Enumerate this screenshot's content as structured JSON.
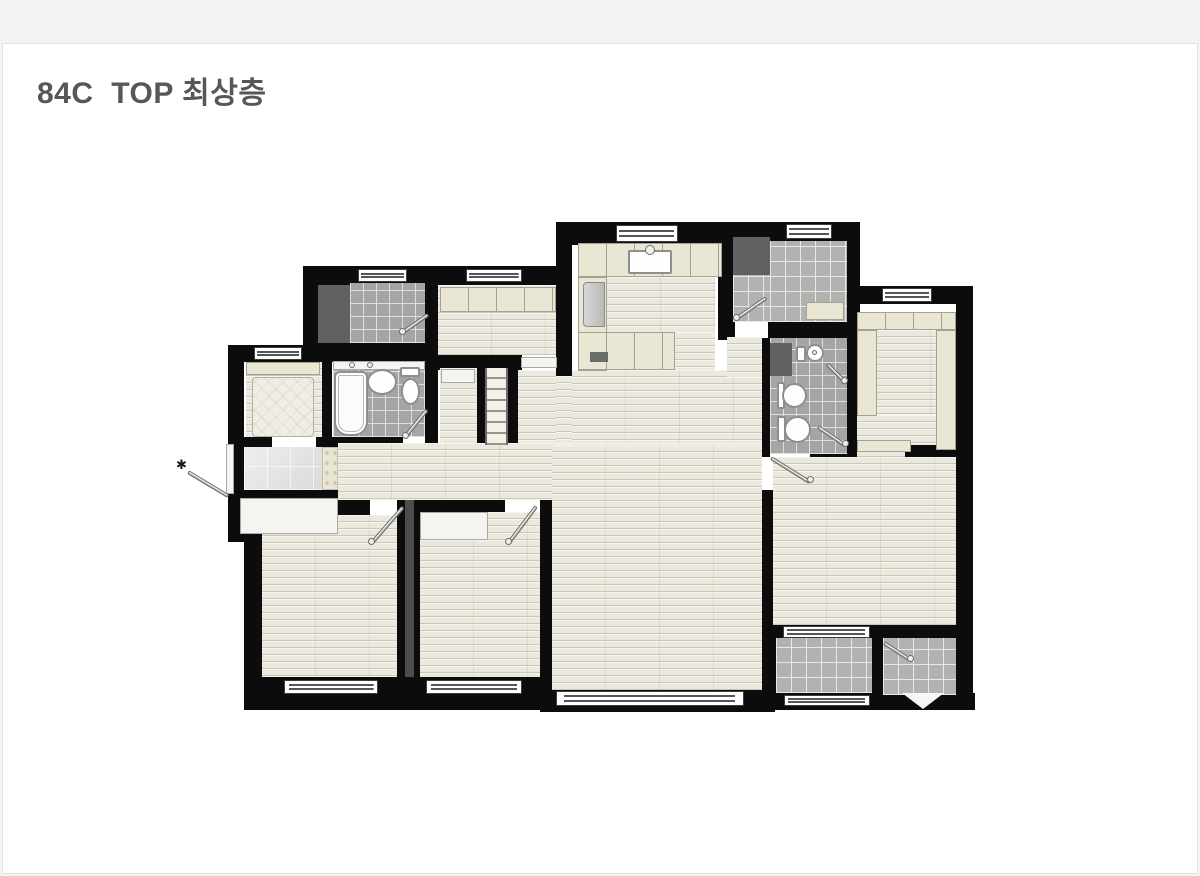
{
  "header": {
    "title": "84C  TOP 최상층"
  },
  "colors": {
    "page_background": "#f3f3f1",
    "card_background": "#ffffff",
    "title_text": "#56575b",
    "wall": "#0c0c0c",
    "wood_floor": "#ebe8dd",
    "bath_tile": "#a5a5a3",
    "balcony_tile": "#b2b2b0",
    "cabinet_beige": "#e9e6d4",
    "dark_unit": "#616161"
  },
  "plan": {
    "elements": [
      {
        "n": "wall-kitchen-top",
        "t": "wall",
        "x": 556,
        "y": 222,
        "w": 177,
        "h": 23
      },
      {
        "n": "wall-kitchen-left",
        "t": "wall",
        "x": 556,
        "y": 245,
        "w": 16,
        "h": 131
      },
      {
        "n": "wall-kitchen-right",
        "t": "wall",
        "x": 718,
        "y": 245,
        "w": 15,
        "h": 95
      },
      {
        "n": "wall-laundry-top",
        "t": "wall",
        "x": 727,
        "y": 222,
        "w": 133,
        "h": 20
      },
      {
        "n": "wall-laundry-right",
        "t": "wall",
        "x": 847,
        "y": 222,
        "w": 13,
        "h": 110
      },
      {
        "n": "wall-utility-top",
        "t": "wall",
        "x": 303,
        "y": 266,
        "w": 142,
        "h": 19
      },
      {
        "n": "wall-utility-left",
        "t": "wall",
        "x": 303,
        "y": 285,
        "w": 15,
        "h": 80
      },
      {
        "n": "wall-pantry-top",
        "t": "wall",
        "x": 445,
        "y": 266,
        "w": 127,
        "h": 19
      },
      {
        "n": "wall-study-top",
        "t": "wall",
        "x": 228,
        "y": 345,
        "w": 102,
        "h": 17
      },
      {
        "n": "wall-left-upper",
        "t": "wall",
        "x": 228,
        "y": 362,
        "w": 16,
        "h": 136
      },
      {
        "n": "wall-utility-bottom",
        "t": "wall",
        "x": 303,
        "y": 343,
        "w": 142,
        "h": 19
      },
      {
        "n": "wall-pantry-left",
        "t": "wall",
        "x": 425,
        "y": 283,
        "w": 13,
        "h": 162
      },
      {
        "n": "wall-pantry-bottom",
        "t": "wall",
        "x": 438,
        "y": 355,
        "w": 84,
        "h": 15
      },
      {
        "n": "wall-stair-rail-left",
        "t": "wall",
        "x": 475,
        "y": 368,
        "w": 10,
        "h": 77
      },
      {
        "n": "wall-stair-rail-right",
        "t": "wall",
        "x": 508,
        "y": 368,
        "w": 10,
        "h": 77
      },
      {
        "n": "wall-bath1-bottom",
        "t": "wall",
        "x": 330,
        "y": 437,
        "w": 73,
        "h": 13
      },
      {
        "n": "wall-study-bottom-left",
        "t": "wall",
        "x": 228,
        "y": 437,
        "w": 44,
        "h": 13
      },
      {
        "n": "wall-study-bottom-right",
        "t": "wall",
        "x": 316,
        "y": 437,
        "w": 16,
        "h": 13
      },
      {
        "n": "wall-porch-block",
        "t": "wall",
        "x": 228,
        "y": 490,
        "w": 124,
        "h": 52
      },
      {
        "n": "wall-bedroom1-top",
        "t": "wall",
        "x": 244,
        "y": 500,
        "w": 126,
        "h": 15
      },
      {
        "n": "wall-left-lower",
        "t": "wall",
        "x": 244,
        "y": 515,
        "w": 18,
        "h": 185
      },
      {
        "n": "wall-bedroom1-bottom",
        "t": "wall",
        "x": 244,
        "y": 677,
        "w": 166,
        "h": 33
      },
      {
        "n": "wall-bedroom-divider",
        "t": "wall",
        "x": 397,
        "y": 500,
        "w": 23,
        "h": 190
      },
      {
        "n": "wall-bedroom2-bottom",
        "t": "wall",
        "x": 410,
        "y": 677,
        "w": 142,
        "h": 33
      },
      {
        "n": "wall-bedroom2-top",
        "t": "wall",
        "x": 413,
        "y": 500,
        "w": 92,
        "h": 14
      },
      {
        "n": "wall-bedroom2-living",
        "t": "wall",
        "x": 540,
        "y": 495,
        "w": 12,
        "h": 215
      },
      {
        "n": "wall-living-bottom",
        "t": "wall",
        "x": 540,
        "y": 690,
        "w": 235,
        "h": 22
      },
      {
        "n": "wall-living-master",
        "t": "wall",
        "x": 762,
        "y": 490,
        "w": 11,
        "h": 147
      },
      {
        "n": "wall-balcony-left",
        "t": "wall",
        "x": 762,
        "y": 625,
        "w": 14,
        "h": 85
      },
      {
        "n": "wall-master-bottom",
        "t": "wall",
        "x": 775,
        "y": 625,
        "w": 193,
        "h": 15
      },
      {
        "n": "wall-balcony-bottom",
        "t": "wall",
        "x": 775,
        "y": 693,
        "w": 200,
        "h": 17
      },
      {
        "n": "wall-right",
        "t": "wall",
        "x": 956,
        "y": 286,
        "w": 17,
        "h": 424
      },
      {
        "n": "wall-dressing-top",
        "t": "wall",
        "x": 847,
        "y": 286,
        "w": 112,
        "h": 18
      },
      {
        "n": "wall-laundry-bottom-left",
        "t": "wall",
        "x": 727,
        "y": 322,
        "w": 8,
        "h": 16
      },
      {
        "n": "wall-laundry-bottom-right",
        "t": "wall",
        "x": 768,
        "y": 322,
        "w": 92,
        "h": 16
      },
      {
        "n": "wall-hall-bath",
        "t": "wall",
        "x": 762,
        "y": 338,
        "w": 8,
        "h": 119
      },
      {
        "n": "wall-bath2-bottom",
        "t": "wall",
        "x": 810,
        "y": 447,
        "w": 50,
        "h": 13
      },
      {
        "n": "wall-bath2-dressing",
        "t": "wall",
        "x": 847,
        "y": 304,
        "w": 13,
        "h": 148
      },
      {
        "n": "wall-dressing-bottom",
        "t": "wall",
        "x": 905,
        "y": 445,
        "w": 51,
        "h": 12
      },
      {
        "n": "wall-balcony-divider",
        "t": "wall",
        "x": 872,
        "y": 637,
        "w": 11,
        "h": 60
      },
      {
        "n": "wall-study-bath",
        "t": "wall",
        "x": 318,
        "y": 362,
        "w": 14,
        "h": 83
      },
      {
        "n": "wall-bath2-partition",
        "t": "wall-thin",
        "x": 795,
        "y": 378,
        "w": 52,
        "h": 4
      },
      {
        "n": "floor-corridor",
        "t": "wood",
        "x": 338,
        "y": 443,
        "w": 424,
        "h": 57
      },
      {
        "n": "floor-living-room",
        "t": "wood",
        "x": 552,
        "y": 445,
        "w": 210,
        "h": 245
      },
      {
        "n": "floor-dining",
        "t": "wood",
        "x": 572,
        "y": 370,
        "w": 190,
        "h": 73
      },
      {
        "n": "floor-hall",
        "t": "wood",
        "x": 727,
        "y": 337,
        "w": 35,
        "h": 40
      },
      {
        "n": "floor-pantry-pass",
        "t": "wood",
        "x": 518,
        "y": 370,
        "w": 38,
        "h": 73
      },
      {
        "n": "floor-pass2",
        "t": "wood",
        "x": 556,
        "y": 376,
        "w": 16,
        "h": 67
      },
      {
        "n": "floor-kitchen-walk",
        "t": "wood",
        "x": 607,
        "y": 277,
        "w": 108,
        "h": 55
      },
      {
        "n": "floor-kitchen-walk2",
        "t": "wood",
        "x": 675,
        "y": 332,
        "w": 40,
        "h": 38
      },
      {
        "n": "floor-pantry",
        "t": "wood",
        "x": 438,
        "y": 285,
        "w": 118,
        "h": 70
      },
      {
        "n": "floor-stair-closet",
        "t": "wood",
        "x": 440,
        "y": 368,
        "w": 37,
        "h": 75
      },
      {
        "n": "floor-study",
        "t": "wood",
        "x": 246,
        "y": 362,
        "w": 76,
        "h": 75
      },
      {
        "n": "floor-bedroom1",
        "t": "wood",
        "x": 262,
        "y": 515,
        "w": 135,
        "h": 162
      },
      {
        "n": "floor-bedroom2",
        "t": "wood",
        "x": 420,
        "y": 512,
        "w": 120,
        "h": 165
      },
      {
        "n": "floor-master-bedroom",
        "t": "wood",
        "x": 773,
        "y": 457,
        "w": 183,
        "h": 168
      },
      {
        "n": "floor-dressing-center",
        "t": "wood",
        "x": 877,
        "y": 330,
        "w": 59,
        "h": 110
      },
      {
        "n": "floor-dressing-lower",
        "t": "wood",
        "x": 857,
        "y": 415,
        "w": 48,
        "h": 42
      },
      {
        "n": "floor-dressing-lower2",
        "t": "wood",
        "x": 905,
        "y": 415,
        "w": 31,
        "h": 30
      },
      {
        "n": "floor-entry",
        "t": "entry",
        "x": 244,
        "y": 447,
        "w": 78,
        "h": 43
      },
      {
        "n": "entry-art-wall",
        "t": "mosaic",
        "x": 322,
        "y": 447,
        "w": 16,
        "h": 43
      },
      {
        "n": "floor-utility-tile",
        "t": "tile",
        "x": 350,
        "y": 283,
        "w": 75,
        "h": 60
      },
      {
        "n": "floor-laundry",
        "t": "tile-light",
        "x": 770,
        "y": 241,
        "w": 77,
        "h": 81
      },
      {
        "n": "floor-laundry2",
        "t": "tile-light",
        "x": 733,
        "y": 275,
        "w": 37,
        "h": 47
      },
      {
        "n": "floor-bath1",
        "t": "tile",
        "x": 333,
        "y": 370,
        "w": 92,
        "h": 67
      },
      {
        "n": "floor-bath2",
        "t": "tile",
        "x": 770,
        "y": 338,
        "w": 77,
        "h": 116
      },
      {
        "n": "floor-balcony",
        "t": "tile-light",
        "x": 776,
        "y": 638,
        "w": 96,
        "h": 55
      },
      {
        "n": "floor-ac-room",
        "t": "tile-light",
        "x": 883,
        "y": 638,
        "w": 73,
        "h": 57
      },
      {
        "n": "stairs-to-roof",
        "t": "stairs",
        "x": 485,
        "y": 368,
        "w": 23,
        "h": 77
      },
      {
        "n": "plumbing-shaft",
        "t": "shaft",
        "x": 405,
        "y": 500,
        "w": 9,
        "h": 177
      },
      {
        "n": "washer-unit",
        "t": "dark",
        "x": 733,
        "y": 237,
        "w": 37,
        "h": 38
      },
      {
        "n": "utility-unit",
        "t": "dark",
        "x": 318,
        "y": 285,
        "w": 32,
        "h": 58
      },
      {
        "n": "bath2-shaft",
        "t": "dark",
        "x": 770,
        "y": 343,
        "w": 22,
        "h": 33
      },
      {
        "n": "kitchen-counter-top",
        "t": "beige-div",
        "x": 578,
        "y": 243,
        "w": 144,
        "h": 34
      },
      {
        "n": "kitchen-counter-left",
        "t": "beige",
        "x": 578,
        "y": 277,
        "w": 29,
        "h": 94
      },
      {
        "n": "kitchen-counter-bottom",
        "t": "beige-div",
        "x": 578,
        "y": 332,
        "w": 97,
        "h": 38
      },
      {
        "n": "pantry-cabinets",
        "t": "beige-div",
        "x": 440,
        "y": 287,
        "w": 116,
        "h": 25
      },
      {
        "n": "refrigerator",
        "t": "fridge",
        "x": 583,
        "y": 282,
        "w": 22,
        "h": 45
      },
      {
        "n": "kitchen-sink",
        "t": "rect-white",
        "x": 628,
        "y": 250,
        "w": 44,
        "h": 24
      },
      {
        "n": "kitchen-faucet",
        "t": "dot",
        "x": 645,
        "y": 245,
        "w": 10,
        "h": 10
      },
      {
        "n": "cooktop",
        "t": "stove",
        "x": 590,
        "y": 352,
        "w": 18,
        "h": 10
      },
      {
        "n": "laundry-bench",
        "t": "beige",
        "x": 806,
        "y": 302,
        "w": 38,
        "h": 18
      },
      {
        "n": "dressing-closet-top",
        "t": "beige-div",
        "x": 857,
        "y": 312,
        "w": 99,
        "h": 18
      },
      {
        "n": "dressing-closet-left",
        "t": "beige",
        "x": 857,
        "y": 330,
        "w": 20,
        "h": 86
      },
      {
        "n": "dressing-closet-right",
        "t": "beige",
        "x": 936,
        "y": 330,
        "w": 20,
        "h": 120
      },
      {
        "n": "dressing-closet-bottom",
        "t": "beige",
        "x": 857,
        "y": 440,
        "w": 54,
        "h": 12
      },
      {
        "n": "bedroom2-closet",
        "t": "porch",
        "x": 420,
        "y": 512,
        "w": 68,
        "h": 28
      },
      {
        "n": "stair-closet-shelf",
        "t": "porch",
        "x": 441,
        "y": 369,
        "w": 34,
        "h": 14
      },
      {
        "n": "study-closet",
        "t": "beige",
        "x": 246,
        "y": 362,
        "w": 74,
        "h": 13
      },
      {
        "n": "study-bed",
        "t": "quilt",
        "x": 252,
        "y": 377,
        "w": 62,
        "h": 60
      },
      {
        "n": "bathtub",
        "t": "tub",
        "x": 334,
        "y": 371,
        "w": 34,
        "h": 65
      },
      {
        "n": "bath1-shelf",
        "t": "porch",
        "x": 333,
        "y": 361,
        "w": 92,
        "h": 9
      },
      {
        "n": "bath1-faucet1",
        "t": "dot",
        "x": 349,
        "y": 362,
        "w": 6,
        "h": 6
      },
      {
        "n": "bath1-faucet2",
        "t": "dot",
        "x": 367,
        "y": 362,
        "w": 6,
        "h": 6
      },
      {
        "n": "bath1-sink",
        "t": "ellipse",
        "x": 367,
        "y": 369,
        "w": 30,
        "h": 26
      },
      {
        "n": "bath1-toilet-tank",
        "t": "rect-white",
        "x": 400,
        "y": 367,
        "w": 20,
        "h": 10
      },
      {
        "n": "bath1-toilet-bowl",
        "t": "ellipse",
        "x": 401,
        "y": 378,
        "w": 19,
        "h": 27
      },
      {
        "n": "bath2-basin",
        "t": "ellipse",
        "x": 806,
        "y": 344,
        "w": 18,
        "h": 18
      },
      {
        "n": "bath2-basin-drain",
        "t": "dot",
        "x": 812,
        "y": 350,
        "w": 5,
        "h": 5
      },
      {
        "n": "bath2-faucet-column",
        "t": "rect-white",
        "x": 796,
        "y": 346,
        "w": 10,
        "h": 16
      },
      {
        "n": "bath2-sink-mount",
        "t": "rect-white",
        "x": 777,
        "y": 382,
        "w": 8,
        "h": 27
      },
      {
        "n": "bath2-sink",
        "t": "ellipse",
        "x": 782,
        "y": 383,
        "w": 25,
        "h": 25
      },
      {
        "n": "bath2-toilet-tank",
        "t": "rect-white",
        "x": 777,
        "y": 416,
        "w": 9,
        "h": 26
      },
      {
        "n": "bath2-toilet-bowl",
        "t": "ellipse",
        "x": 784,
        "y": 416,
        "w": 27,
        "h": 27
      },
      {
        "n": "entrance-porch",
        "t": "porch",
        "x": 240,
        "y": 498,
        "w": 98,
        "h": 36
      },
      {
        "n": "entrance-door-frame",
        "t": "porch",
        "x": 226,
        "y": 444,
        "w": 8,
        "h": 50
      },
      {
        "n": "pantry-door-threshold",
        "t": "porch",
        "x": 521,
        "y": 357,
        "w": 36,
        "h": 11
      },
      {
        "n": "window-kitchen",
        "t": "window",
        "x": 616,
        "y": 225,
        "w": 62,
        "h": 17
      },
      {
        "n": "window-utility",
        "t": "window",
        "x": 358,
        "y": 269,
        "w": 49,
        "h": 13
      },
      {
        "n": "window-pantry",
        "t": "window",
        "x": 466,
        "y": 269,
        "w": 56,
        "h": 13
      },
      {
        "n": "window-laundry",
        "t": "window",
        "x": 786,
        "y": 224,
        "w": 46,
        "h": 15
      },
      {
        "n": "window-dressing",
        "t": "window",
        "x": 882,
        "y": 288,
        "w": 50,
        "h": 14
      },
      {
        "n": "window-study",
        "t": "window",
        "x": 254,
        "y": 347,
        "w": 48,
        "h": 13
      },
      {
        "n": "window-bedroom1",
        "t": "window",
        "x": 284,
        "y": 680,
        "w": 94,
        "h": 14
      },
      {
        "n": "window-bedroom2",
        "t": "window",
        "x": 426,
        "y": 680,
        "w": 96,
        "h": 14
      },
      {
        "n": "window-living",
        "t": "window",
        "x": 556,
        "y": 691,
        "w": 188,
        "h": 15
      },
      {
        "n": "window-master-balcony",
        "t": "window",
        "x": 783,
        "y": 626,
        "w": 87,
        "h": 12
      },
      {
        "n": "window-balcony-outer",
        "t": "window",
        "x": 784,
        "y": 695,
        "w": 86,
        "h": 11
      },
      {
        "n": "door-bath1",
        "t": "line",
        "x": 405,
        "y": 435,
        "w": 35,
        "a": -51
      },
      {
        "n": "door-utility",
        "t": "line",
        "x": 402,
        "y": 331,
        "w": 32,
        "a": -35
      },
      {
        "n": "door-laundry",
        "t": "line",
        "x": 736,
        "y": 317,
        "w": 37,
        "a": -35
      },
      {
        "n": "door-bedroom1",
        "t": "line",
        "x": 371,
        "y": 542,
        "w": 49,
        "a": -49
      },
      {
        "n": "door-bedroom2",
        "t": "line",
        "x": 508,
        "y": 542,
        "w": 47,
        "a": -53
      },
      {
        "n": "door-master-bedroom",
        "t": "line",
        "x": 771,
        "y": 456,
        "w": 46,
        "a": 32
      },
      {
        "n": "door-shower",
        "t": "line",
        "x": 827,
        "y": 362,
        "w": 25,
        "a": 45
      },
      {
        "n": "door-bath2",
        "t": "line",
        "x": 818,
        "y": 425,
        "w": 33,
        "a": 34
      },
      {
        "n": "door-ac-room",
        "t": "line",
        "x": 884,
        "y": 641,
        "w": 31,
        "a": 33
      },
      {
        "n": "entrance-arrow",
        "t": "line",
        "x": 188,
        "y": 470,
        "w": 47,
        "a": 31
      },
      {
        "n": "handle-bedroom1",
        "t": "dot",
        "x": 368,
        "y": 538,
        "w": 7,
        "h": 7
      },
      {
        "n": "handle-bedroom2",
        "t": "dot",
        "x": 505,
        "y": 538,
        "w": 7,
        "h": 7
      },
      {
        "n": "handle-bath1",
        "t": "dot",
        "x": 402,
        "y": 432,
        "w": 7,
        "h": 7
      },
      {
        "n": "handle-utility",
        "t": "dot",
        "x": 399,
        "y": 328,
        "w": 7,
        "h": 7
      },
      {
        "n": "handle-laundry",
        "t": "dot",
        "x": 733,
        "y": 314,
        "w": 7,
        "h": 7
      },
      {
        "n": "handle-master",
        "t": "dot",
        "x": 807,
        "y": 476,
        "w": 7,
        "h": 7
      },
      {
        "n": "handle-shower",
        "t": "dot",
        "x": 841,
        "y": 377,
        "w": 7,
        "h": 7
      },
      {
        "n": "handle-bath2",
        "t": "dot",
        "x": 842,
        "y": 440,
        "w": 7,
        "h": 7
      },
      {
        "n": "handle-ac",
        "t": "dot",
        "x": 907,
        "y": 655,
        "w": 7,
        "h": 7
      },
      {
        "n": "ac-room-hatch",
        "t": "tri",
        "x": 902,
        "y": 693,
        "w": 42,
        "h": 16
      },
      {
        "n": "entrance-marker",
        "t": "star",
        "x": 176,
        "y": 458,
        "txt": "✱"
      }
    ]
  }
}
